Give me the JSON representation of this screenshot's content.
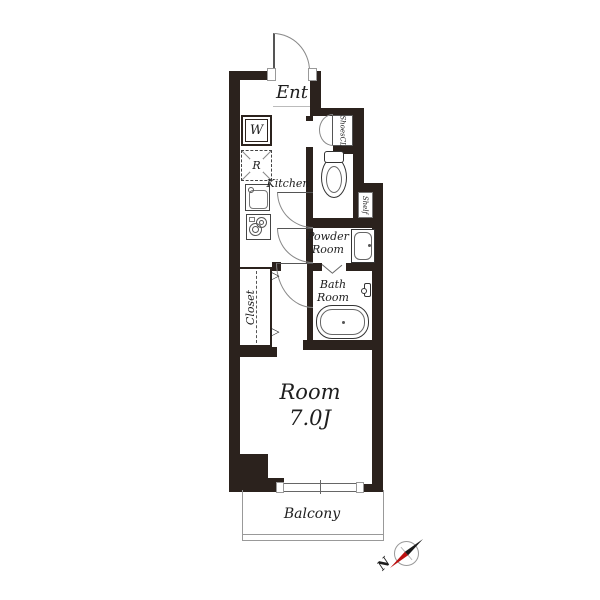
{
  "floor_plan": {
    "rooms": {
      "entrance": "Ent",
      "shoes_closet": "ShoesCL",
      "kitchen": "Kitchen",
      "shelf": "Shelf",
      "powder_room": [
        "Powder",
        "Room"
      ],
      "bath_room": [
        "Bath",
        "Room"
      ],
      "closet": "Closet",
      "main_room_name": "Room",
      "main_room_size": "7.0J",
      "balcony": "Balcony"
    },
    "appliances": {
      "washer": "W",
      "refrigerator": "R"
    },
    "markers": {
      "closet_door_marker": "▷"
    },
    "compass": {
      "north_label": "N"
    },
    "colors": {
      "wall": "#2b221d",
      "fixture_line": "#333333",
      "thin_line": "#999999",
      "compass_red": "#bb1111",
      "text": "#1e1e1e"
    }
  }
}
